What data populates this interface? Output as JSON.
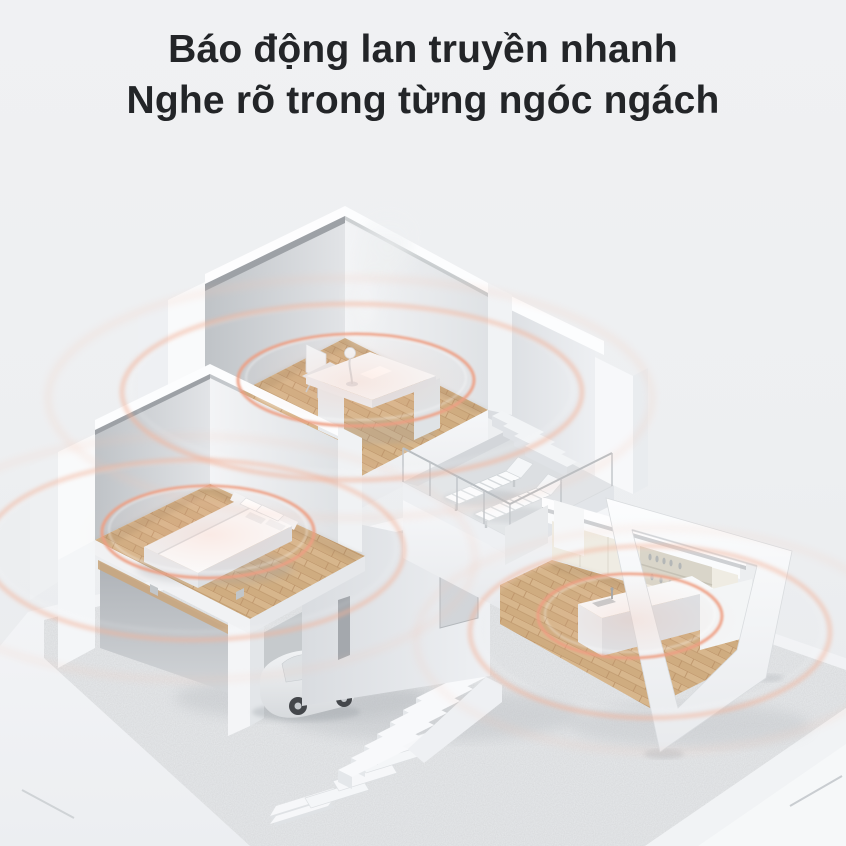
{
  "page": {
    "width": 846,
    "height": 846,
    "background": "#edeff1"
  },
  "heading": {
    "line1": "Báo động lan truyền nhanh",
    "line2": "Nghe rõ trong từng ngóc ngách",
    "color": "#232528"
  },
  "palette": {
    "background": "#edeff1",
    "heading_text": "#232528",
    "ripple_strong": "#ee9f83",
    "ripple_mid": "#f3b299",
    "ripple_soft": "#f6c4b0",
    "ripple_glow": "#f4a68a",
    "wood_floor": "#d7b68c",
    "wood_dark": "#bb9268",
    "wall_white": "#fbfcfd",
    "wall_shadow": "#bfc3c7",
    "gravel": "#e7e9eb",
    "smoke": "#eff1f2",
    "car_body": "#e3e6e9"
  },
  "illustration": {
    "type": "isometric-house-cutaway",
    "alarm_rings_per_room": 3,
    "rooms": [
      {
        "name": "study",
        "objects": [
          "desk",
          "office-chair",
          "desk-lamp",
          "smoke-plume"
        ],
        "alarm_ripple": true
      },
      {
        "name": "bedroom",
        "objects": [
          "double-bed",
          "pillows"
        ],
        "alarm_ripple": true
      },
      {
        "name": "kitchen",
        "objects": [
          "upper-cabinets",
          "open-shelves-with-dishes",
          "kitchen-island",
          "sink",
          "window-frame"
        ],
        "alarm_ripple": true
      },
      {
        "name": "terrace",
        "objects": [
          "sun-lounger",
          "sun-lounger",
          "glass-railing",
          "interior-stairs"
        ],
        "alarm_ripple": false
      }
    ],
    "ground_objects": [
      "gravel-yard",
      "white-walkway",
      "car",
      "carport-column",
      "outdoor-staircase",
      "stepping-stones"
    ]
  }
}
